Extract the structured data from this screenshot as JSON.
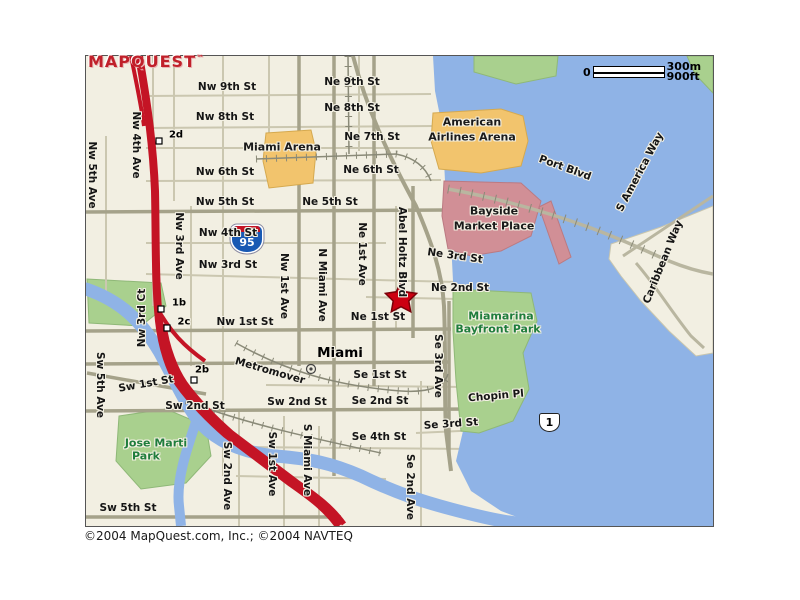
{
  "logo": {
    "text": "MAPQUEST",
    "tm": "™"
  },
  "scale": {
    "zero": "0",
    "metric": "300m",
    "imperial": "900ft"
  },
  "shields": {
    "i95": "95",
    "us1": "1"
  },
  "copyright": "©2004 MapQuest.com, Inc.; ©2004 NAVTEQ",
  "city": "Miami",
  "marker": {
    "type": "star",
    "color": "#cc0011",
    "near": "Ne 1st St / Abel Holtz Blvd"
  },
  "colors": {
    "water": "#8fb3e6",
    "land": "#f2efe2",
    "park_fill": "#a9d08e",
    "arena_fill": "#f2c46d",
    "mall_fill": "#d18f96",
    "highway": "#c41425",
    "major_road": "#a5a28a",
    "minor_road": "#cbc7b0",
    "park_text": "#1f7d3c",
    "logo_red": "#c0202a"
  },
  "labels": [
    {
      "t": "Nw 9th St",
      "x": 227,
      "y": 87,
      "r": 0,
      "c": "st"
    },
    {
      "t": "Ne 9th St",
      "x": 352,
      "y": 82,
      "r": 0,
      "c": "st"
    },
    {
      "t": "Nw 8th St",
      "x": 225,
      "y": 117,
      "r": 0,
      "c": "st"
    },
    {
      "t": "Ne 8th St",
      "x": 352,
      "y": 108,
      "r": 0,
      "c": "st"
    },
    {
      "t": "Ne 7th St",
      "x": 372,
      "y": 137,
      "r": 0,
      "c": "st"
    },
    {
      "t": "Nw 6th St",
      "x": 225,
      "y": 172,
      "r": 0,
      "c": "st"
    },
    {
      "t": "Ne 6th St",
      "x": 371,
      "y": 170,
      "r": 0,
      "c": "st"
    },
    {
      "t": "Nw 5th St",
      "x": 225,
      "y": 202,
      "r": 0,
      "c": "st"
    },
    {
      "t": "Ne 5th St",
      "x": 330,
      "y": 202,
      "r": 0,
      "c": "st"
    },
    {
      "t": "Nw 4th St",
      "x": 228,
      "y": 233,
      "r": 0,
      "c": "st"
    },
    {
      "t": "Nw 3rd St",
      "x": 228,
      "y": 265,
      "r": 0,
      "c": "st"
    },
    {
      "t": "Ne 3rd St",
      "x": 455,
      "y": 256,
      "r": 8,
      "c": "st"
    },
    {
      "t": "Ne 2nd St",
      "x": 460,
      "y": 288,
      "r": 0,
      "c": "st"
    },
    {
      "t": "Nw 1st St",
      "x": 245,
      "y": 322,
      "r": 0,
      "c": "st"
    },
    {
      "t": "Ne 1st St",
      "x": 378,
      "y": 317,
      "r": 0,
      "c": "st"
    },
    {
      "t": "Se 1st St",
      "x": 380,
      "y": 375,
      "r": 0,
      "c": "st"
    },
    {
      "t": "Sw 2nd St",
      "x": 195,
      "y": 406,
      "r": 0,
      "c": "st"
    },
    {
      "t": "Sw 2nd St",
      "x": 297,
      "y": 402,
      "r": 0,
      "c": "st"
    },
    {
      "t": "Se 2nd St",
      "x": 380,
      "y": 401,
      "r": 0,
      "c": "st"
    },
    {
      "t": "Se 3rd St",
      "x": 451,
      "y": 424,
      "r": -4,
      "c": "st"
    },
    {
      "t": "Se 4th St",
      "x": 379,
      "y": 437,
      "r": 0,
      "c": "st"
    },
    {
      "t": "Sw 1st St",
      "x": 146,
      "y": 384,
      "r": -10,
      "c": "st"
    },
    {
      "t": "Sw 5th St",
      "x": 128,
      "y": 508,
      "r": 0,
      "c": "st"
    },
    {
      "t": "Chopin Pl",
      "x": 496,
      "y": 396,
      "r": -5,
      "c": "st"
    },
    {
      "t": "Metromover",
      "x": 270,
      "y": 371,
      "r": 16,
      "c": "st"
    },
    {
      "t": "Port Blvd",
      "x": 565,
      "y": 168,
      "r": 20,
      "c": "st"
    },
    {
      "t": "S America Way",
      "x": 640,
      "y": 172,
      "r": -62,
      "c": "st"
    },
    {
      "t": "Caribbean Way",
      "x": 663,
      "y": 262,
      "r": -68,
      "c": "st"
    },
    {
      "t": "Nw 5th Ave",
      "x": 92,
      "y": 175,
      "r": 90,
      "c": "st"
    },
    {
      "t": "Nw 4th Ave",
      "x": 136,
      "y": 145,
      "r": 90,
      "c": "st"
    },
    {
      "t": "Nw 3rd Ave",
      "x": 179,
      "y": 246,
      "r": 90,
      "c": "st"
    },
    {
      "t": "Nw 3rd Ct",
      "x": 142,
      "y": 318,
      "r": -90,
      "c": "st"
    },
    {
      "t": "Nw 1st Ave",
      "x": 284,
      "y": 286,
      "r": 90,
      "c": "st"
    },
    {
      "t": "N Miami Ave",
      "x": 322,
      "y": 285,
      "r": 90,
      "c": "st"
    },
    {
      "t": "Ne 1st Ave",
      "x": 362,
      "y": 254,
      "r": 90,
      "c": "st"
    },
    {
      "t": "Abel Holtz Blvd",
      "x": 402,
      "y": 252,
      "r": 90,
      "c": "st"
    },
    {
      "t": "Se 3rd Ave",
      "x": 438,
      "y": 366,
      "r": 90,
      "c": "st"
    },
    {
      "t": "Se 2nd Ave",
      "x": 410,
      "y": 487,
      "r": 90,
      "c": "st"
    },
    {
      "t": "S Miami Ave",
      "x": 307,
      "y": 460,
      "r": 90,
      "c": "st"
    },
    {
      "t": "Sw 1st Ave",
      "x": 272,
      "y": 464,
      "r": 90,
      "c": "st"
    },
    {
      "t": "Sw 2nd Ave",
      "x": 227,
      "y": 476,
      "r": 90,
      "c": "st"
    },
    {
      "t": "Sw 5th Ave",
      "x": 100,
      "y": 385,
      "r": 90,
      "c": "st"
    },
    {
      "t": "Miami Arena",
      "x": 282,
      "y": 147,
      "r": 0,
      "c": "place"
    },
    {
      "t": "American",
      "x": 472,
      "y": 122,
      "r": 0,
      "c": "place"
    },
    {
      "t": "Airlines Arena",
      "x": 472,
      "y": 137,
      "r": 0,
      "c": "place"
    },
    {
      "t": "Bayside",
      "x": 494,
      "y": 211,
      "r": 0,
      "c": "place"
    },
    {
      "t": "Market Place",
      "x": 494,
      "y": 226,
      "r": 0,
      "c": "place"
    },
    {
      "t": "Miami",
      "x": 340,
      "y": 353,
      "r": 0,
      "c": "city"
    },
    {
      "t": "Jose Marti",
      "x": 156,
      "y": 443,
      "r": 0,
      "c": "park"
    },
    {
      "t": "Park",
      "x": 146,
      "y": 456,
      "r": 0,
      "c": "park"
    },
    {
      "t": "Miamarina",
      "x": 501,
      "y": 316,
      "r": 0,
      "c": "park"
    },
    {
      "t": "Bayfront Park",
      "x": 498,
      "y": 329,
      "r": 0,
      "c": "park"
    },
    {
      "t": "2d",
      "x": 176,
      "y": 135,
      "r": 0,
      "c": "exit"
    },
    {
      "t": "1b",
      "x": 179,
      "y": 303,
      "r": 0,
      "c": "exit"
    },
    {
      "t": "2c",
      "x": 184,
      "y": 322,
      "r": 0,
      "c": "exit"
    },
    {
      "t": "2b",
      "x": 202,
      "y": 370,
      "r": 0,
      "c": "exit"
    }
  ]
}
